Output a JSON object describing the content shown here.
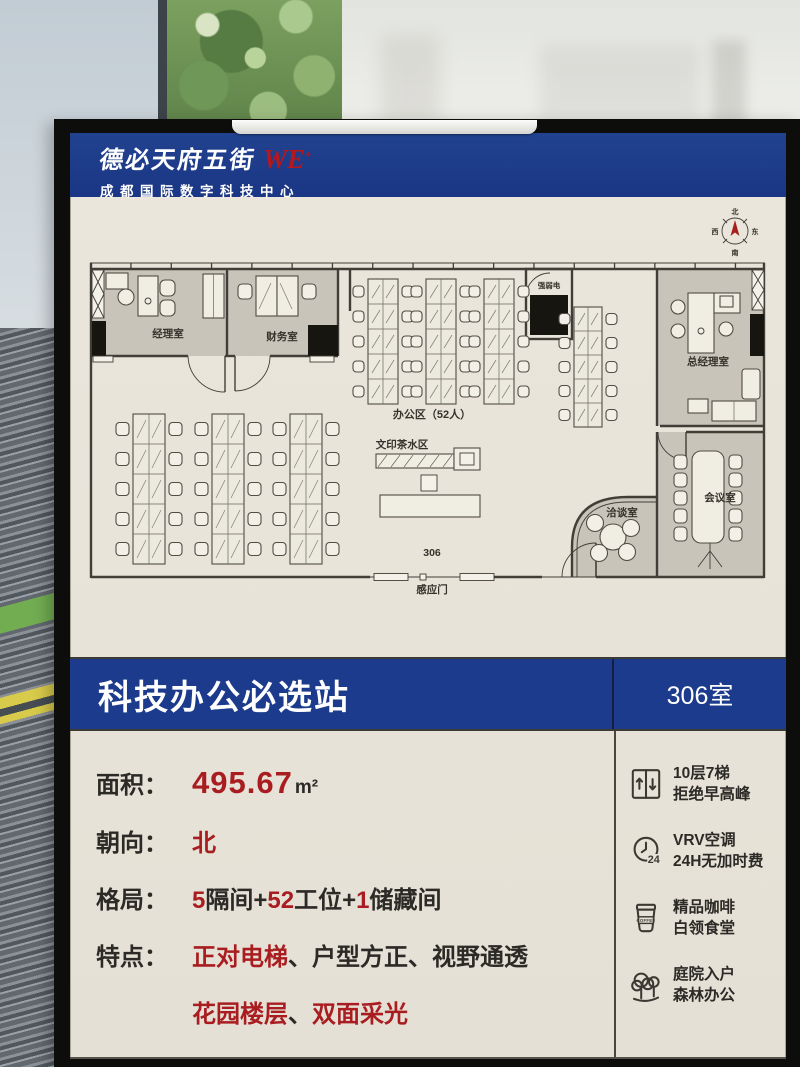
{
  "header": {
    "brand": "德必天府五街",
    "brand_logo": "WE",
    "brand_logo_sup": "+",
    "subtitle": "成都国际数字科技中心"
  },
  "floor_plan": {
    "compass": {
      "north": "北",
      "east": "东",
      "south": "南",
      "west": "西"
    },
    "rooms": {
      "manager": "经理室",
      "finance": "财务室",
      "power": "强弱电",
      "gm": "总经理室",
      "meeting": "会议室",
      "negotiation": "洽谈室"
    },
    "labels": {
      "office_area": "办公区（52人）",
      "print_tea": "文印茶水区",
      "room_number": "306",
      "sensor_door": "感应门"
    }
  },
  "banner": {
    "title": "科技办公必选站",
    "room": "306室"
  },
  "details": {
    "rows": [
      {
        "label": "面积：",
        "segments": [
          {
            "text": "495.67"
          },
          {
            "text": "m²"
          }
        ]
      },
      {
        "label": "朝向：",
        "segments": [
          {
            "text": "北"
          }
        ]
      },
      {
        "label": "格局：",
        "segments": [
          {
            "text": "5"
          },
          {
            "text": "隔间+"
          },
          {
            "text": "52"
          },
          {
            "text": "工位+"
          },
          {
            "text": "1"
          },
          {
            "text": "储藏间"
          }
        ]
      },
      {
        "label": "特点：",
        "segments": [
          {
            "text": "正对电梯"
          },
          {
            "text": "、"
          },
          {
            "text": "户型方正"
          },
          {
            "text": "、"
          },
          {
            "text": "视野通透"
          }
        ]
      },
      {
        "label": "",
        "segments": [
          {
            "text": "花园楼层"
          },
          {
            "text": "、"
          },
          {
            "text": "双面采光"
          }
        ]
      }
    ]
  },
  "amenities": [
    {
      "icon": "elevator-icon",
      "line1": "10层7梯",
      "line2": "拒绝早高峰"
    },
    {
      "icon": "clock-24-icon",
      "icon_text": "24",
      "line1": "VRV空调",
      "line2": "24H无加时费"
    },
    {
      "icon": "coffee-icon",
      "icon_text": "COFFEE",
      "line1": "精品咖啡",
      "line2": "白领食堂"
    },
    {
      "icon": "trees-icon",
      "line1": "庭院入户",
      "line2": "森林办公"
    }
  ]
}
